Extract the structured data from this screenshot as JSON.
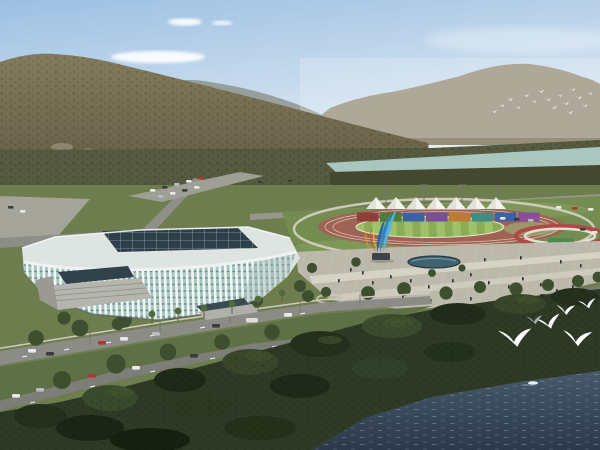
{
  "scene": {
    "type": "aerial-architectural-rendering",
    "subject": "Lakeside sports complex: white lattice arena, athletics track with colorful stand wall and white canopies, forested mountains behind, plaza with flame sculpture, dark lake in front with white gulls",
    "counts": {
      "white_canopies": 7,
      "stand_panels": 8,
      "foreground_gulls": 6,
      "distant_flock_birds": 16
    }
  },
  "palette": {
    "sky_top": "#9cc0e2",
    "sky_mid": "#c9dcee",
    "sky_horizon": "#edf3f7",
    "cloud_white": "#ffffff",
    "hills_blue": "#8e948e",
    "ridge": "#978f78",
    "mountain_top": "#837b5c",
    "mountain_base": "#645e44",
    "river": "#a9c6bf",
    "treeband": "#565a3e",
    "treeband_low": "#44482f",
    "base_ground": "#6d7d4e",
    "lawn": "#748c50",
    "lawn_light": "#87a05e",
    "track": "#a06353",
    "infield_a": "#8aac57",
    "infield_b": "#9ec268",
    "lane_line": "#ece8de",
    "ring_path": "#d5d1c3",
    "tent": "#f4f4ef",
    "tent_shade": "#cfcfc4",
    "flower_ring": "#b04848",
    "canopy_green": "#4d8a52",
    "plaza": "#bcb9ac",
    "plaza_light": "#dad7ca",
    "road": "#8c8c86",
    "road_dark": "#7e7e78",
    "sidewalk": "#cfccbe",
    "pavement_light": "#a4a49a",
    "grass_median": "#5e7045",
    "pool": "#3f6470",
    "people": "#35352f",
    "sculpture_blue": "#2e84c6",
    "sculpture_cyan": "#55b4e4",
    "sculpture_deep": "#1f63a8",
    "sculpture_orange": "#e6992e",
    "sculpture_red": "#d14f28",
    "sculpture_yellow": "#f2c23e",
    "building_body": "#e7ebe9",
    "building_roof": "#dde4e2",
    "skylight": "#2f3f49",
    "skylight_grid": "#9fb4ba",
    "glass": "#a3c6be",
    "glass_floor": "#43565c",
    "rib": "#f6f8f7",
    "entrance_glass": "#32424a",
    "stairs": "#b5b5ae",
    "tree_canopy": "#3e4f30",
    "fg_tree": "#2e3a25",
    "fg_tree_dark": "#1f2918",
    "fg_tree_light": "#46582f",
    "water_top": "#48596c",
    "water_bottom": "#2b394b",
    "ripple": "#9fb2c2",
    "boat": "#e8eef2",
    "gull_white": "#ffffff",
    "gull_gray": "#a7adad",
    "car_white": "#e9e9e7",
    "car_red": "#b23530",
    "car_dark": "#3c3c3c",
    "car_silver": "#b9bdc1"
  },
  "stand_panels": [
    "#8f3f3a",
    "#4e7c3e",
    "#3e61a6",
    "#7a4e99",
    "#bf7a36",
    "#3e8d83",
    "#3e61a6",
    "#8a4f9a"
  ]
}
